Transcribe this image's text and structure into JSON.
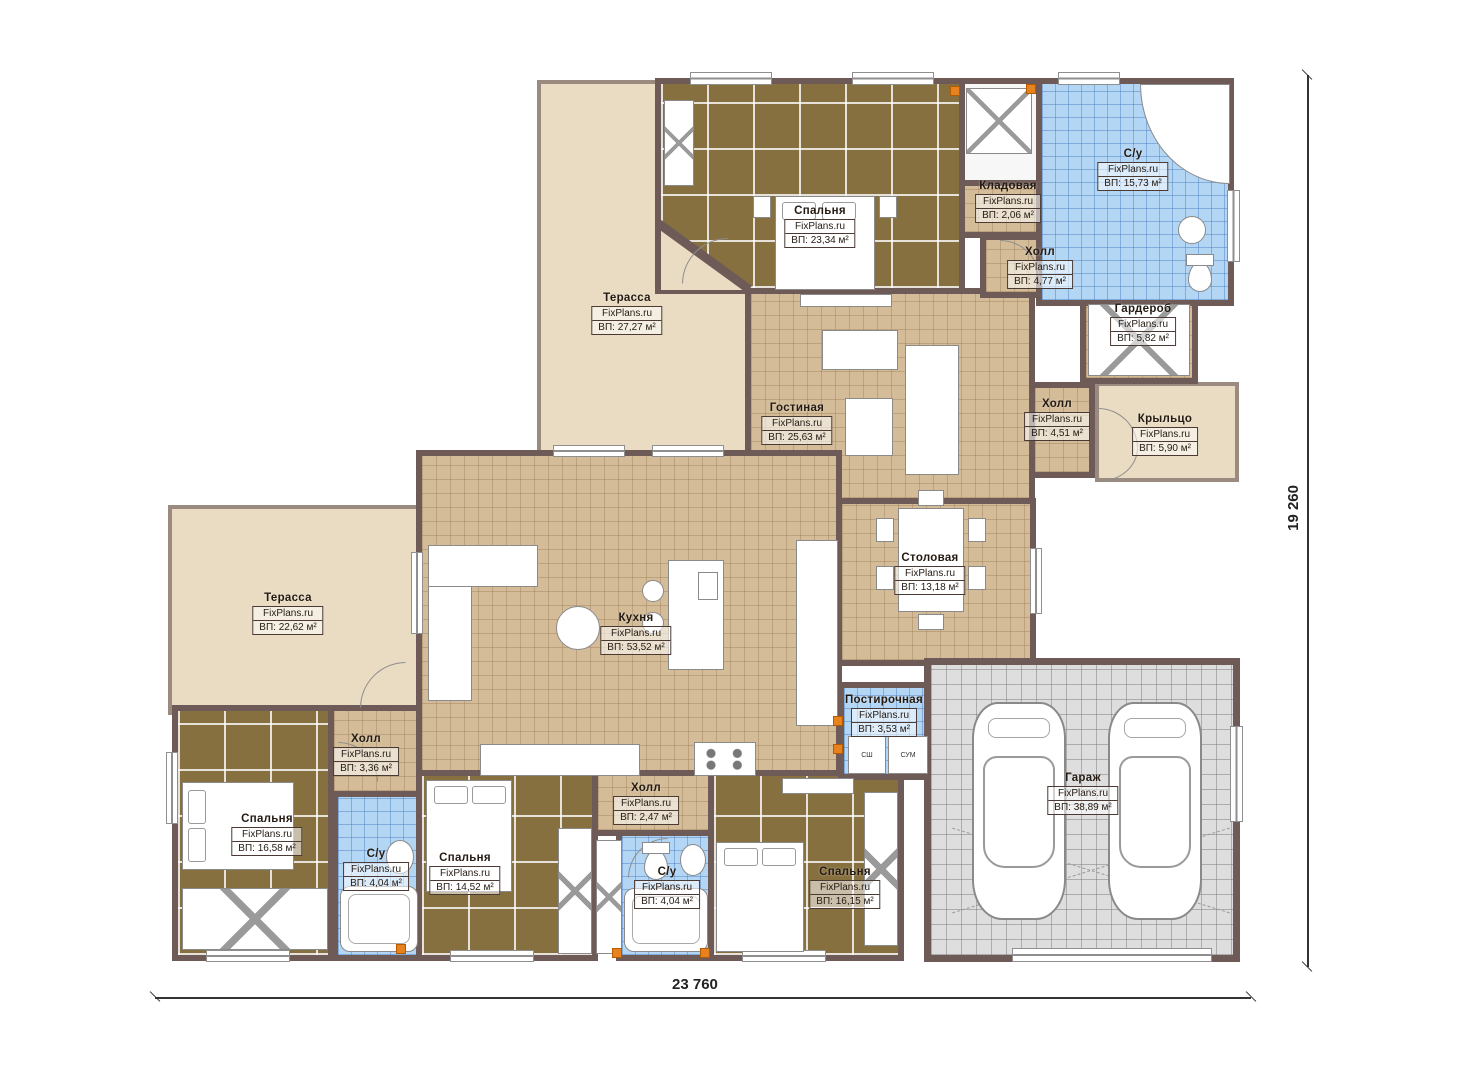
{
  "plan": {
    "brand": "FixPlans.ru",
    "dim_width": "23 760",
    "dim_height": "19 260"
  },
  "rooms": [
    {
      "name": "Терасса",
      "area": "ВП: 27,27 м²"
    },
    {
      "name": "Спальня",
      "area": "ВП: 23,34 м²"
    },
    {
      "name": "С/у",
      "area": "ВП: 15,73 м²"
    },
    {
      "name": "Кладовая",
      "area": "ВП: 2,06 м²"
    },
    {
      "name": "Холл",
      "area": "ВП: 4,77 м²"
    },
    {
      "name": "Гардероб",
      "area": "ВП: 5,82 м²"
    },
    {
      "name": "Гостиная",
      "area": "ВП: 25,63 м²"
    },
    {
      "name": "Холл",
      "area": "ВП: 4,51 м²"
    },
    {
      "name": "Крыльцо",
      "area": "ВП: 5,90 м²"
    },
    {
      "name": "Столовая",
      "area": "ВП: 13,18 м²"
    },
    {
      "name": "Кухня",
      "area": "ВП: 53,52 м²"
    },
    {
      "name": "Терасса",
      "area": "ВП: 22,62 м²"
    },
    {
      "name": "Холл",
      "area": "ВП: 3,36 м²"
    },
    {
      "name": "Спальня",
      "area": "ВП: 16,58 м²"
    },
    {
      "name": "С/у",
      "area": "ВП: 4,04 м²"
    },
    {
      "name": "Спальня",
      "area": "ВП: 14,52 м²"
    },
    {
      "name": "Холл",
      "area": "ВП: 2,47 м²"
    },
    {
      "name": "С/у",
      "area": "ВП: 4,04 м²"
    },
    {
      "name": "Спальня",
      "area": "ВП: 16,15 м²"
    },
    {
      "name": "Постирочная",
      "area": "ВП: 3,53 м²"
    },
    {
      "name": "Гараж",
      "area": "ВП: 38,89 м²"
    }
  ],
  "laundry": {
    "washer_label": "СШ",
    "dryer_label": "СУМ"
  },
  "colors": {
    "wall": "#6e5b57",
    "floor_tile": "#d3bc97",
    "floor_bedroom": "#877040",
    "floor_bath": "#b3d6f4",
    "floor_terrace": "#e9dcc2",
    "floor_garage": "#dedede",
    "outlet_accent": "#e8821e"
  }
}
